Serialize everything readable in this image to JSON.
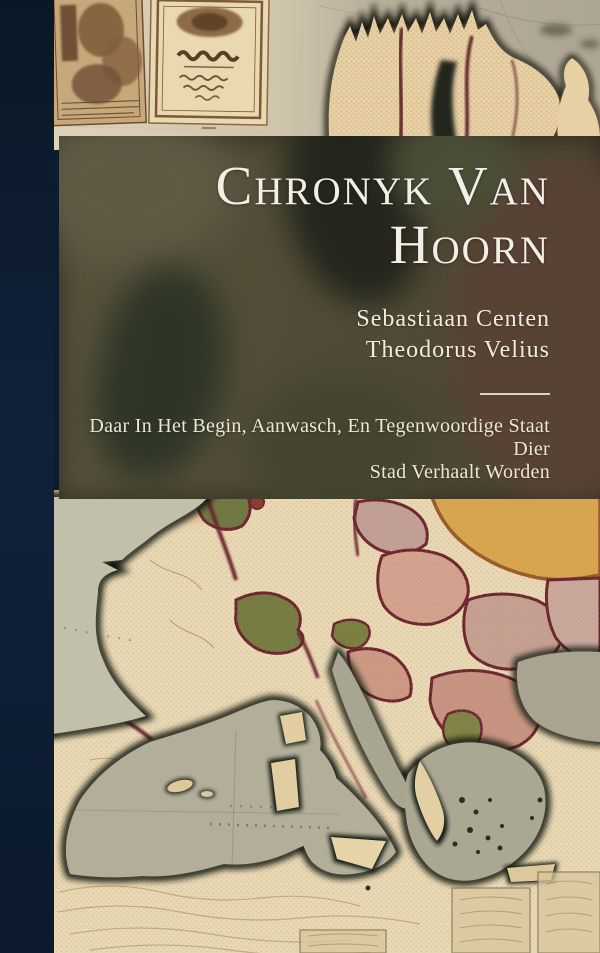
{
  "cover": {
    "title_lines": [
      "Chronyk Van",
      "Hoorn"
    ],
    "authors": [
      "Sebastiaan Centen",
      "Theodorus Velius"
    ],
    "subtitle_lines": [
      "Daar In Het Begin, Aanwasch, En Tegenwoordige Staat Dier",
      "Stad Verhaalt Worden"
    ],
    "colors": {
      "spine_navy": "#0d1c30",
      "panel_olive": "#504b36",
      "title_text": "#f3efe6",
      "map_land": "#e9d8b4",
      "map_sea": "#b2ae99",
      "border_maroon": "#6d2530",
      "region_green": "#747c42",
      "region_pink": "#d3a38f",
      "region_yellow": "#d7a64f"
    }
  }
}
